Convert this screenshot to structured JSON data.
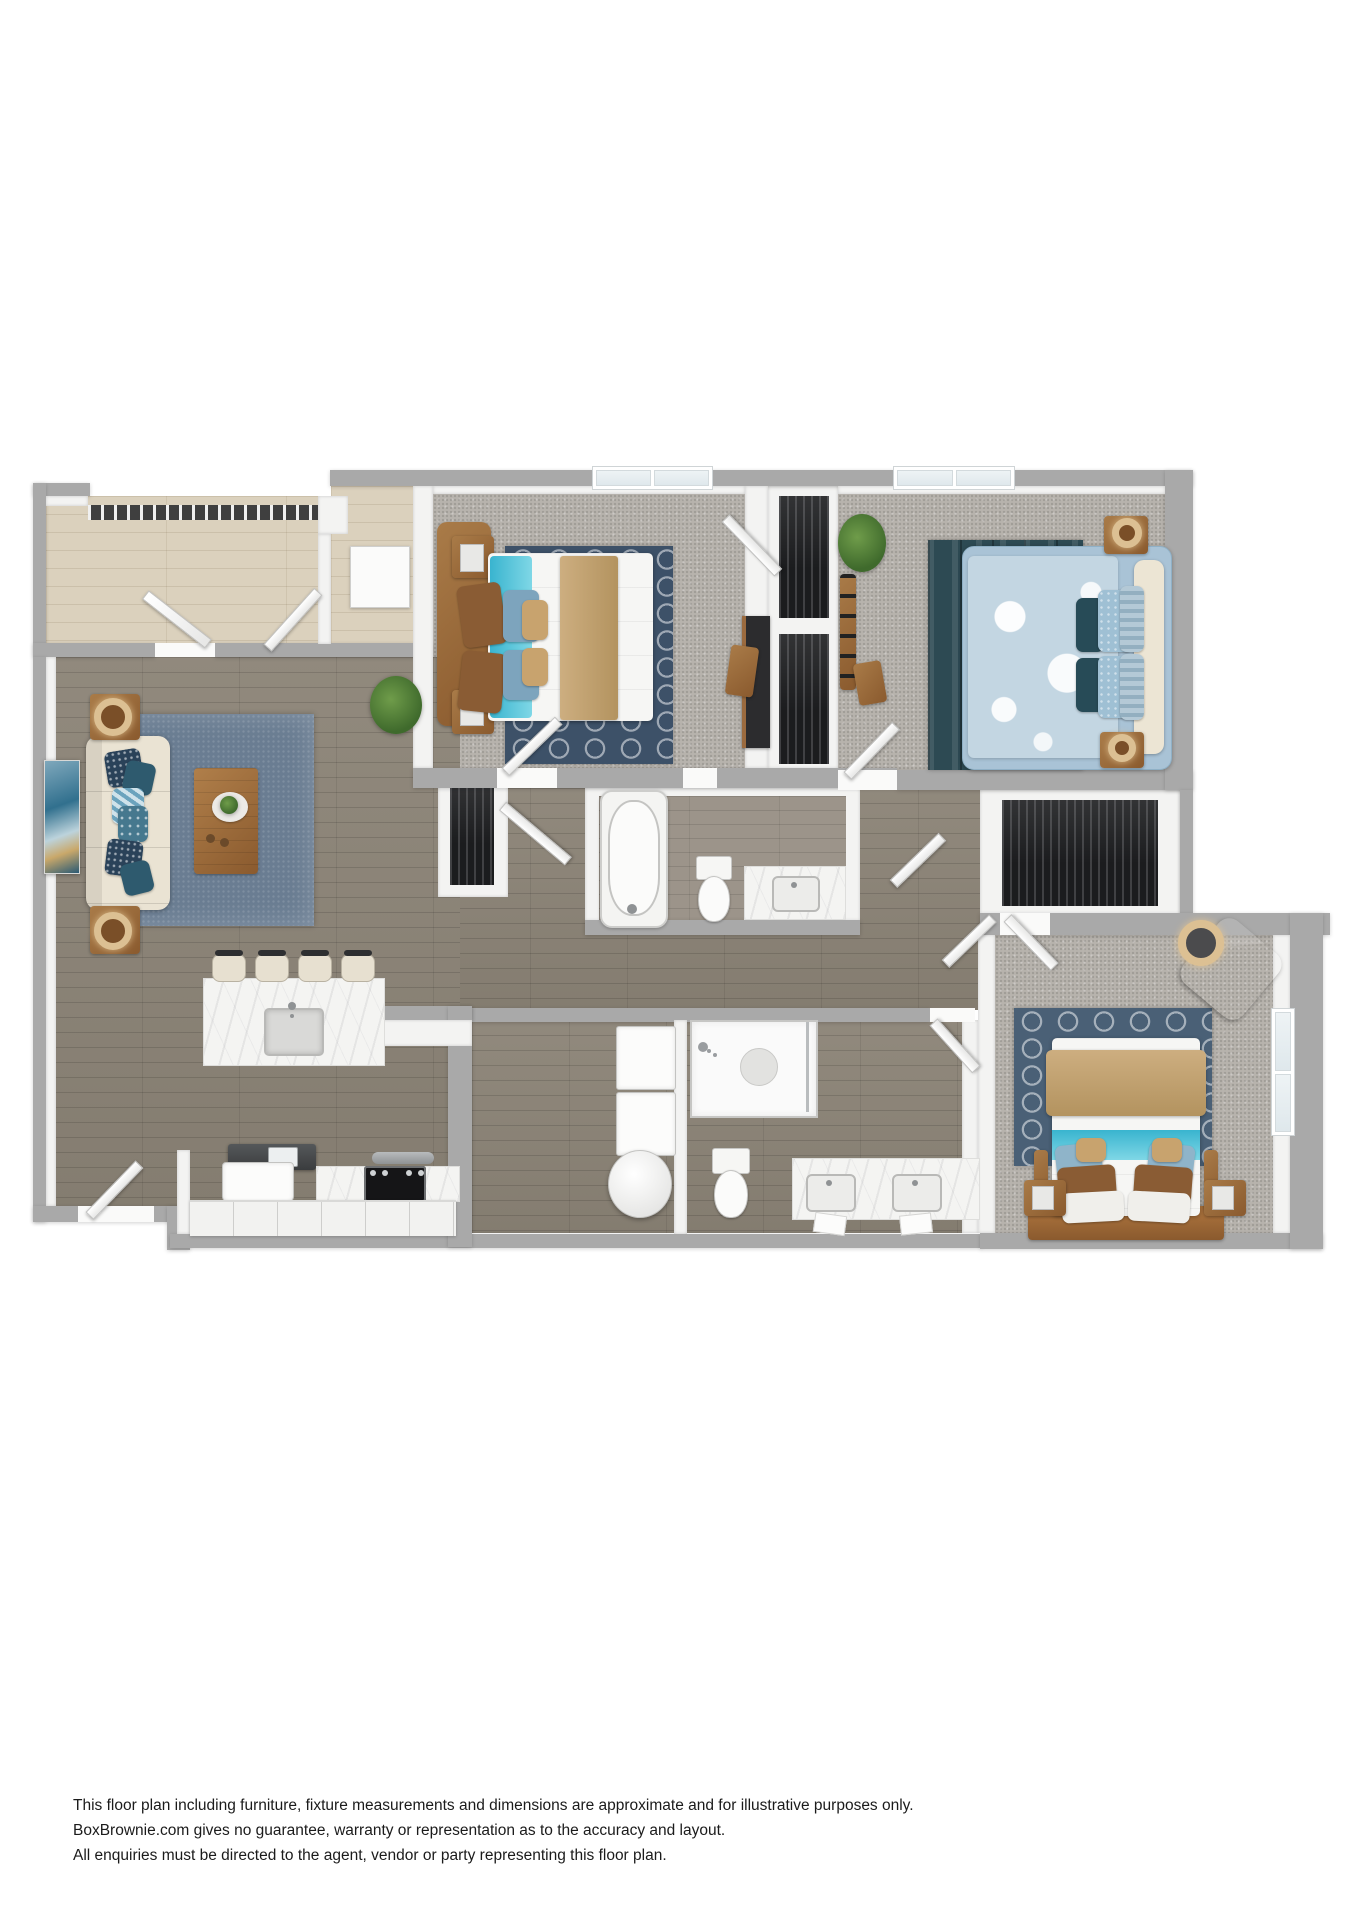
{
  "disclaimer": {
    "line1": "This floor plan including furniture, fixture measurements and dimensions are approximate and for illustrative purposes only.",
    "line2": "BoxBrownie.com gives no guarantee, warranty or representation as to the accuracy and layout.",
    "line3": "All enquiries must be directed to the agent, vendor or party representing this floor plan."
  },
  "palette": {
    "wall_outer": "#a9a9a9",
    "wall_inner": "#f3f3f2",
    "carpet": "#b7b3ad",
    "wood_dark": "#8b8376",
    "wood_bath": "#9c948a",
    "wood_light": "#dbd1bd",
    "marble": "#f4f4f2",
    "rug_living": "#6a7d92",
    "rug_navy": "#3d5168",
    "rug_teal": "#2d4a53",
    "rug_blue": "#4a6076",
    "sofa_cream": "#eae3d3",
    "tan": "#c8a87c",
    "teal": "#4fc0d6",
    "bed_blue": "#a9c3d6",
    "duvet_blue": "#c3d6e2",
    "navy_pillow": "#2a4259",
    "dark_closet": "#1b1c1e",
    "stove_black": "#151517",
    "gold": "#dcc093",
    "green": "#4e7c3a"
  }
}
